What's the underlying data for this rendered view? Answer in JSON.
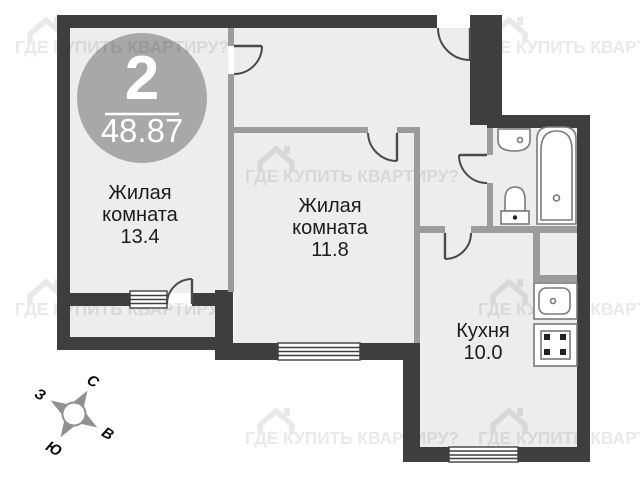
{
  "floorplan": {
    "badge": {
      "rooms_count": "2",
      "total_area": "48.87"
    },
    "rooms": {
      "room1": {
        "line1": "Жилая",
        "line2": "комната",
        "area": "13.4"
      },
      "room2": {
        "line1": "Жилая",
        "line2": "комната",
        "area": "11.8"
      },
      "kitchen": {
        "line1": "Кухня",
        "area": "10.0"
      }
    },
    "compass": {
      "n": "С",
      "e": "В",
      "s": "Ю",
      "w": "З"
    },
    "watermark_text": "ГДЕ КУПИТЬ КВАРТИРУ?",
    "colors": {
      "wall_dark": "#3e3e3e",
      "wall_interior": "#9c9c9c",
      "floor": "#ededed",
      "badge": "#a8a8a8",
      "background": "#ffffff"
    }
  }
}
